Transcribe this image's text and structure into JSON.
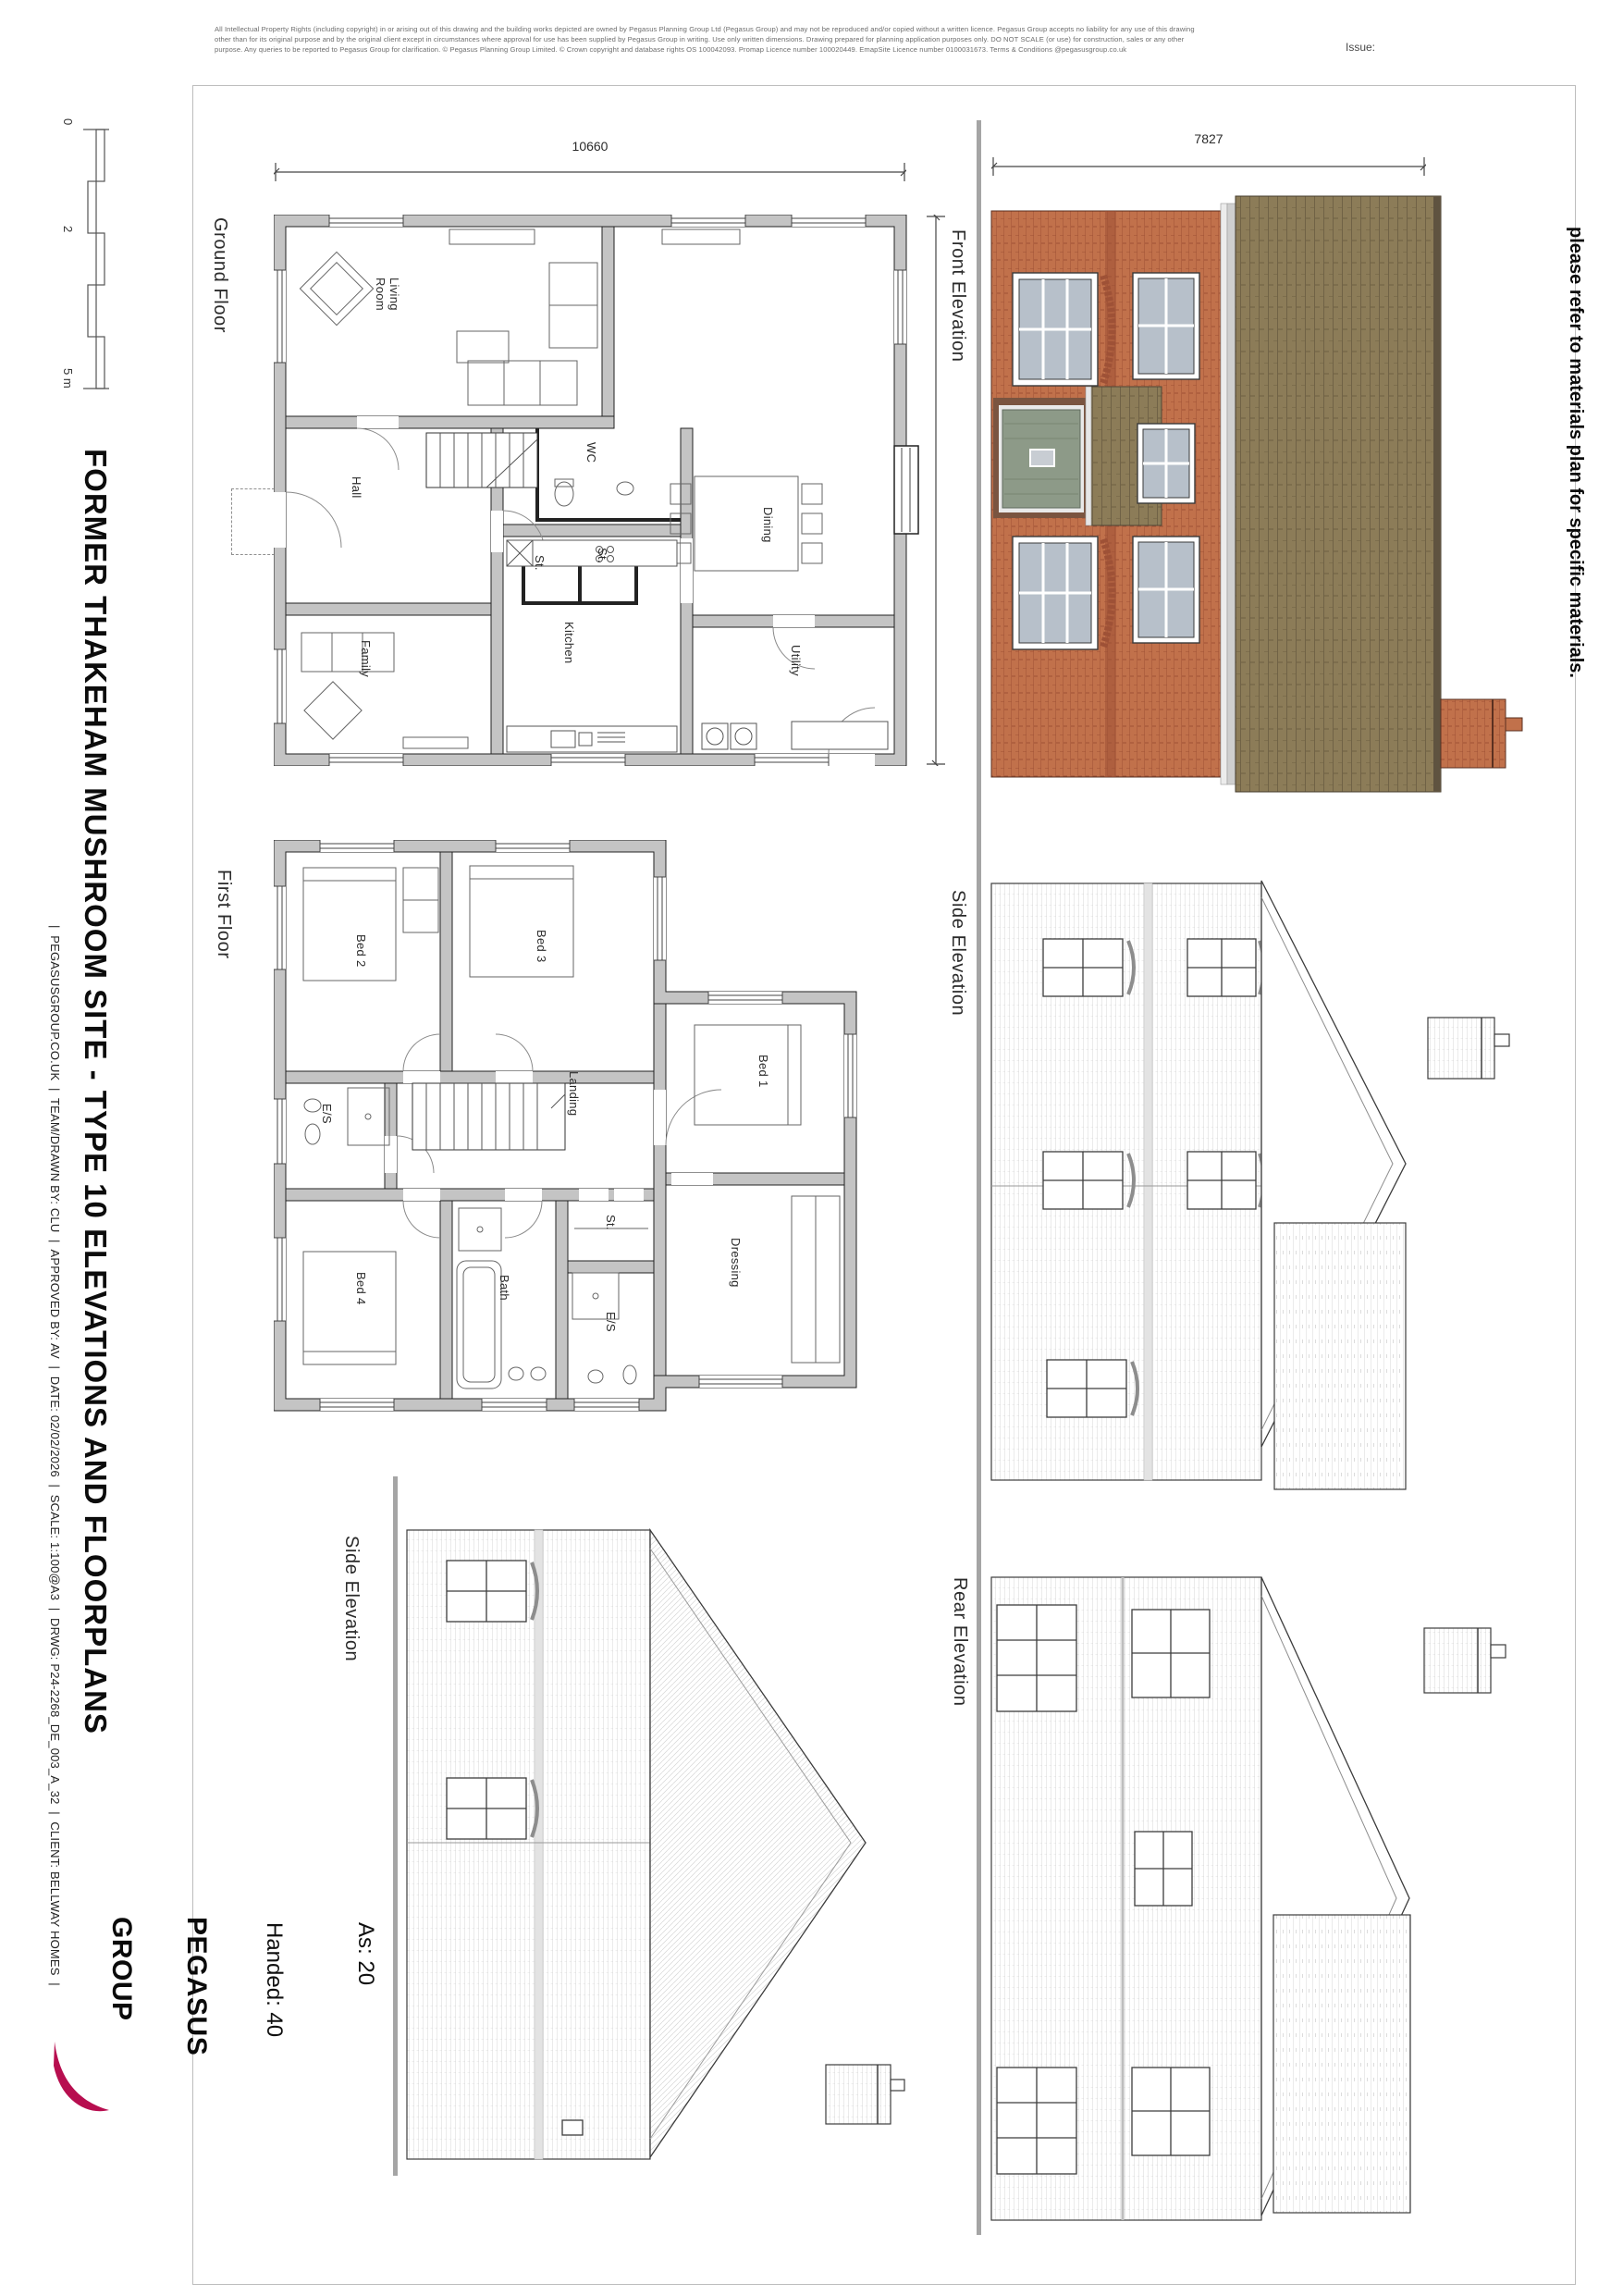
{
  "sheet": {
    "issue_label": "Issue:",
    "disclaimer_lines": [
      "All Intellectual Property Rights (including copyright) in or arising out of this drawing and the building works depicted are owned by Pegasus Planning Group Ltd (Pegasus Group) and may not be reproduced and/or copied without a written licence. Pegasus Group accepts no liability for any use of this drawing",
      "other than for its original purpose and by the original client except in circumstances where approval for use has been supplied by Pegasus Group in writing.  Use only written dimensions.  Drawing prepared for planning application purposes only. DO NOT SCALE (or use) for construction, sales or any other",
      "purpose.  Any queries to be reported to Pegasus Group for clarification.  © Pegasus Planning Group Limited. © Crown copyright and database rights OS 100042093.  Promap  Licence number 100020449. EmapSite Licence number 0100031673. Terms & Conditions @pegasusgroup.co.uk"
    ]
  },
  "title_block": {
    "title": "FORMER THAKEHAM MUSHROOM SITE - TYPE 10 ELEVATIONS AND FLOORPLANS",
    "info_line": "|  PEGASUSGROUP.CO.UK  |  TEAM/DRAWN BY: CLU  |  APPROVED BY: AV  |  DATE: 02/02/2026  |  SCALE: 1:100@A3  |  DRWG: P24-2268_DE_003_A_32  |  CLIENT: BELLWAY HOMES  |",
    "logo": {
      "line1": "PEGASUS",
      "line2": "GROUP"
    }
  },
  "scale_bar": {
    "labels": [
      "0",
      "2",
      "5 m"
    ]
  },
  "note": {
    "line1": "Note: Front elevation is coloured for illustration purposes.",
    "line2": "please refer to materials plan for specific materials."
  },
  "plot_numbers": {
    "heading": "Plot Numbers",
    "as": "As: 20",
    "handed": "Handed: 40"
  },
  "floor_plans": {
    "ground_floor": {
      "label": "Ground Floor",
      "dim_width": "10660",
      "dim_depth": "9920",
      "rooms": [
        {
          "label": "Living\nRoom"
        },
        {
          "label": "Hall"
        },
        {
          "label": "WC"
        },
        {
          "label": "Dining"
        },
        {
          "label": "St."
        },
        {
          "label": "St."
        },
        {
          "label": "Family"
        },
        {
          "label": "Kitchen"
        },
        {
          "label": "Utility"
        }
      ]
    },
    "first_floor": {
      "label": "First Floor",
      "rooms": [
        {
          "label": "Bed 2"
        },
        {
          "label": "Bed 3"
        },
        {
          "label": "E/S"
        },
        {
          "label": "Landing"
        },
        {
          "label": "Bed 1"
        },
        {
          "label": "Bed 4"
        },
        {
          "label": "Bath"
        },
        {
          "label": "St."
        },
        {
          "label": "E/S"
        },
        {
          "label": "Dressing"
        }
      ]
    }
  },
  "elevations": {
    "front": {
      "label": "Front Elevation",
      "dim": "7827"
    },
    "side_right": {
      "label": "Side Elevation"
    },
    "rear": {
      "label": "Rear Elevation"
    },
    "side_left": {
      "label": "Side Elevation"
    }
  },
  "colors": {
    "brick": "#c1714b",
    "brick_dark": "#9e5136",
    "roof": "#8c7c58",
    "roof_dark": "#665a40",
    "window": "#b7c0ca",
    "door_green": "#8d9a88",
    "accent": "#b70e4f",
    "wall_gray": "#c4c4c4",
    "line_gray": "#a5a5a5"
  }
}
